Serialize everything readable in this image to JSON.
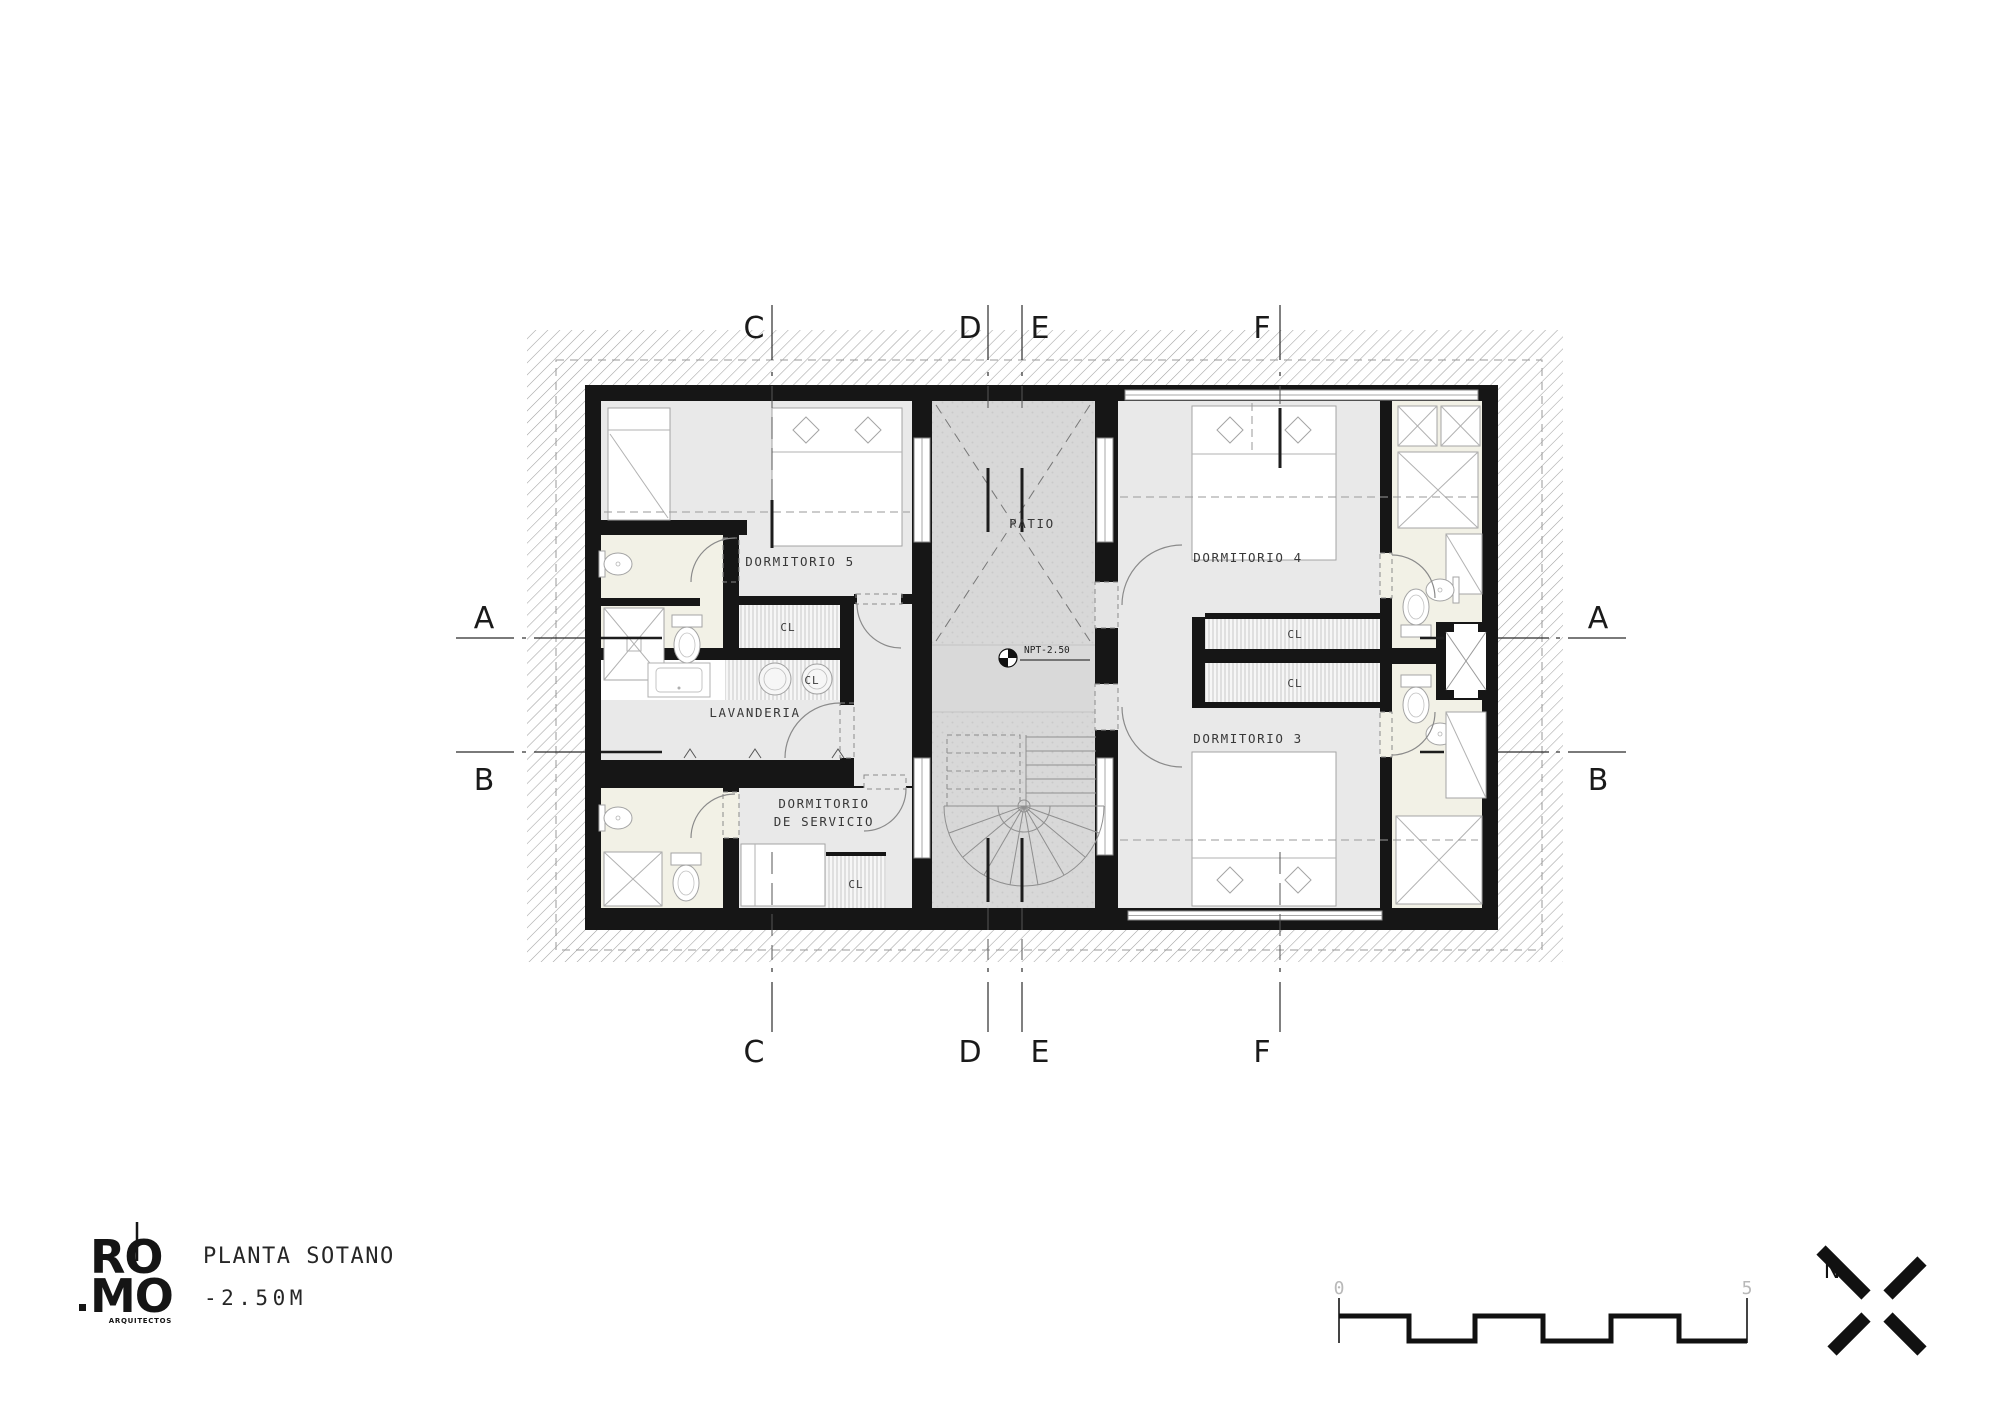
{
  "plan": {
    "grid_letters": {
      "a": "A",
      "b": "B",
      "c": "C",
      "d": "D",
      "e": "E",
      "f": "F"
    },
    "rooms": {
      "dormitorio5": "DORMITORIO 5",
      "dormitorio4": "DORMITORIO 4",
      "dormitorio3": "DORMITORIO 3",
      "lavanderia": "LAVANDERIA",
      "servicio_line1": "DORMITORIO",
      "servicio_line2": "DE SERVICIO",
      "patio": "PATIO",
      "closet": "CL"
    },
    "level_marker": "NPT-2.50"
  },
  "title_block": {
    "logo_top": "RO",
    "logo_bottom": "MO",
    "logo_sub": "ARQUITECTOS",
    "plan_title": "PLANTA SOTANO",
    "plan_level": "-2.50M"
  },
  "scale_bar": {
    "start": "0",
    "end": "5"
  },
  "north_arrow": {
    "label": "N"
  },
  "colors": {
    "wall": "#161616",
    "room": "#e9e9e9",
    "bathroom": "#f2f1e6",
    "patio": "#d8d8d8",
    "landing": "#d9d9d9",
    "closet_bg": "#f6f6f6",
    "hatch_line": "#a2a2a2",
    "label": "#383838",
    "scale_text": "#b9b9b9"
  }
}
